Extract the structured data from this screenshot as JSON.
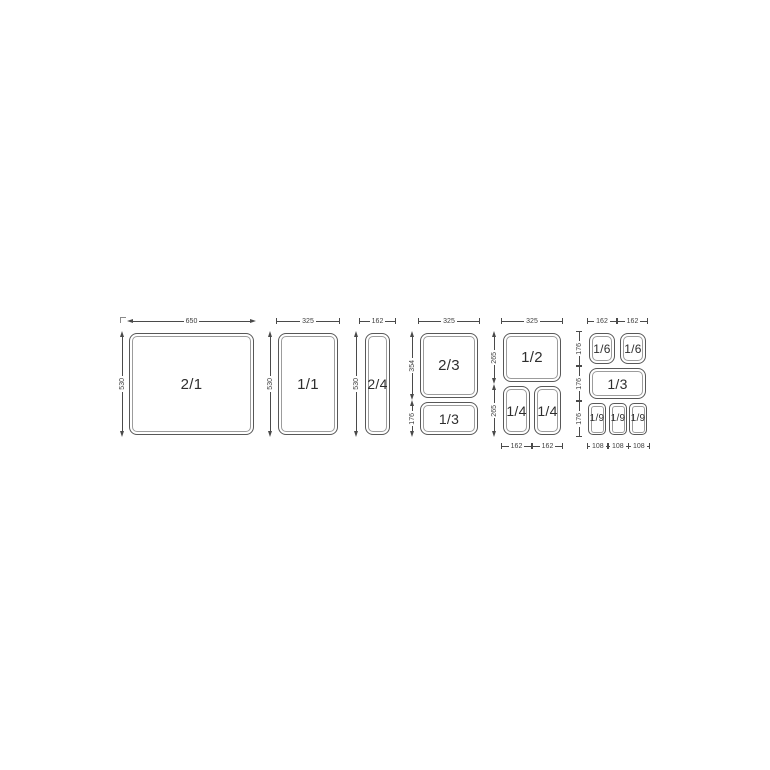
{
  "colors": {
    "background": "#ffffff",
    "dim_line": "#4a4a4a",
    "pan_border": "#585858",
    "pan_inner_rim": "#9c9c9c",
    "pan_text": "#2e2e2e",
    "dim_text": "#3f3f3f"
  },
  "diagram": {
    "groups": [
      {
        "top_dims": [
          "650"
        ],
        "left_dims": [
          "530"
        ],
        "pans": [
          {
            "label": "2/1"
          }
        ]
      },
      {
        "top_dims": [
          "325"
        ],
        "left_dims": [
          "530"
        ],
        "pans": [
          {
            "label": "1/1"
          }
        ]
      },
      {
        "top_dims": [
          "162"
        ],
        "left_dims": [
          "530"
        ],
        "pans": [
          {
            "label": "2/4"
          }
        ]
      },
      {
        "top_dims": [
          "325"
        ],
        "left_dims": [
          "354",
          "176"
        ],
        "pans": [
          {
            "label": "2/3"
          },
          {
            "label": "1/3"
          }
        ]
      },
      {
        "top_dims": [
          "325"
        ],
        "left_dims": [
          "265",
          "265"
        ],
        "bottom_dims": [
          "162",
          "162"
        ],
        "pans": [
          {
            "label": "1/2"
          },
          {
            "label": "1/4"
          },
          {
            "label": "1/4"
          }
        ]
      },
      {
        "top_dims": [
          "162",
          "162"
        ],
        "left_dims": [
          "176",
          "176",
          "176"
        ],
        "bottom_dims": [
          "108",
          "108",
          "108"
        ],
        "pans": [
          {
            "label": "1/6"
          },
          {
            "label": "1/6"
          },
          {
            "label": "1/3"
          },
          {
            "label": "1/9"
          },
          {
            "label": "1/9"
          },
          {
            "label": "1/9"
          }
        ]
      }
    ]
  }
}
